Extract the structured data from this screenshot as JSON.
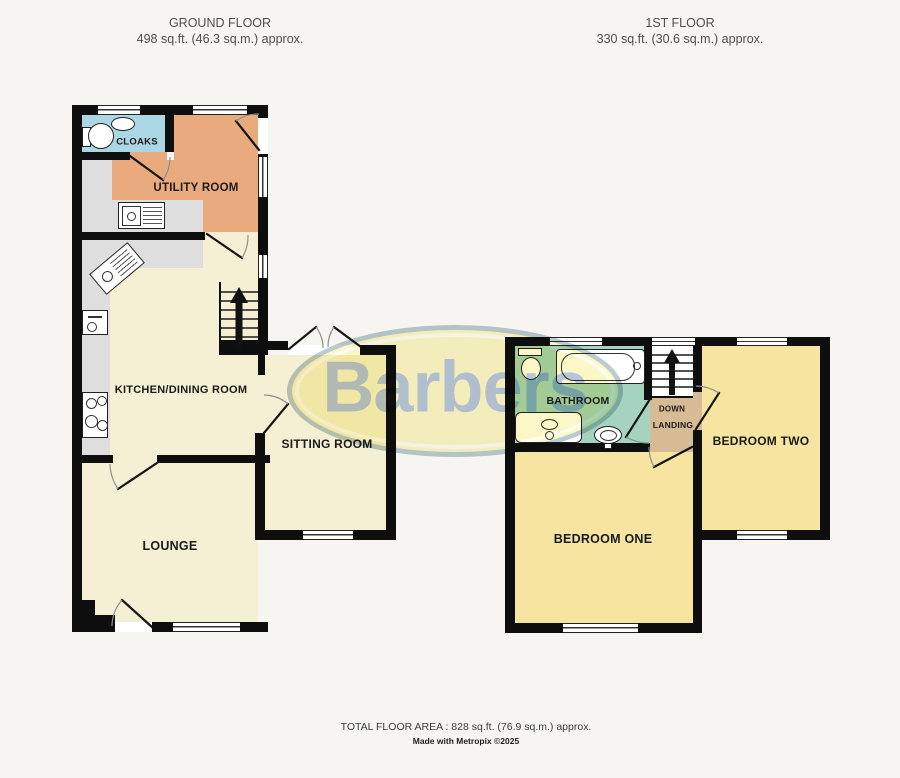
{
  "headers": {
    "ground": {
      "title": "GROUND FLOOR",
      "area": "498 sq.ft. (46.3 sq.m.) approx."
    },
    "first": {
      "title": "1ST FLOOR",
      "area": "330 sq.ft. (30.6 sq.m.) approx."
    }
  },
  "rooms": {
    "cloaks": "CLOAKS",
    "utility": "UTILITY ROOM",
    "kitchen": "KITCHEN/DINING ROOM",
    "sitting": "SITTING ROOM",
    "lounge": "LOUNGE",
    "bathroom": "BATHROOM",
    "down": "DOWN",
    "landing": "LANDING",
    "bedroom_two": "BEDROOM TWO",
    "bedroom_one": "BEDROOM ONE"
  },
  "watermark": "Barbers",
  "footer": {
    "total": "TOTAL FLOOR AREA : 828 sq.ft. (76.9 sq.m.) approx.",
    "credit": "Made with Metropix ©2025"
  },
  "colors": {
    "wall": "#0e0e0e",
    "background": "#f6f5f1",
    "room_cream": "#f5efd3",
    "utility_orange": "#e9ab7e",
    "cloaks_blue": "#aad7e3",
    "bathroom_green": "#a6d2c0",
    "landing_tan": "#d6bb94",
    "bedroom_yellow": "#f6e4a0",
    "counter_gray": "#dedede",
    "watermark_fill": "#fbf7c6",
    "watermark_text": "#b7c6da"
  }
}
